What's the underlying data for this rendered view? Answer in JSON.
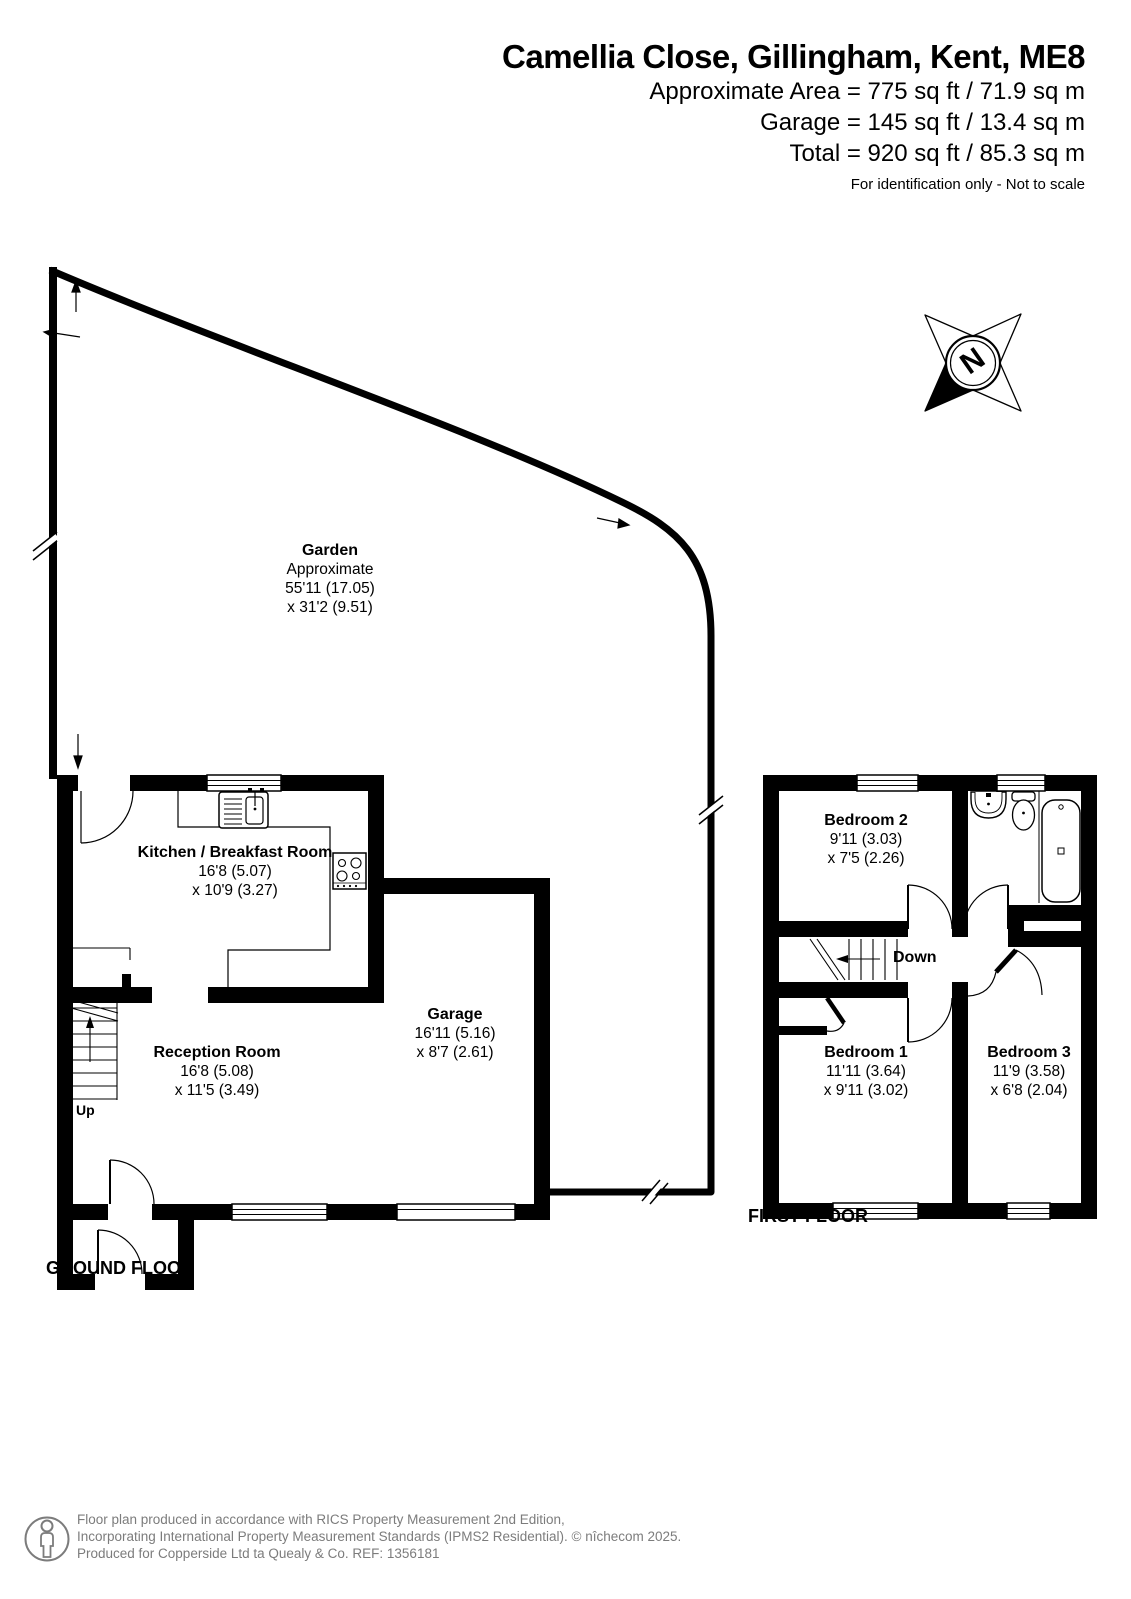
{
  "header": {
    "title": "Camellia Close, Gillingham, Kent, ME8",
    "area_line1": "Approximate Area = 775 sq ft / 71.9 sq m",
    "area_line2": "Garage = 145 sq ft / 13.4 sq m",
    "area_line3": "Total = 920 sq ft / 85.3 sq m",
    "disclaimer": "For identification only - Not to scale"
  },
  "compass": {
    "label": "N"
  },
  "rooms": {
    "garden": {
      "name": "Garden",
      "note": "Approximate",
      "dim1": "55'11 (17.05)",
      "dim2": "x 31'2 (9.51)"
    },
    "kitchen": {
      "name": "Kitchen / Breakfast Room",
      "dim1": "16'8 (5.07)",
      "dim2": "x 10'9 (3.27)"
    },
    "reception": {
      "name": "Reception Room",
      "dim1": "16'8 (5.08)",
      "dim2": "x 11'5 (3.49)"
    },
    "garage": {
      "name": "Garage",
      "dim1": "16'11 (5.16)",
      "dim2": "x 8'7 (2.61)"
    },
    "bedroom1": {
      "name": "Bedroom 1",
      "dim1": "11'11 (3.64)",
      "dim2": "x 9'11 (3.02)"
    },
    "bedroom2": {
      "name": "Bedroom 2",
      "dim1": "9'11 (3.03)",
      "dim2": "x 7'5 (2.26)"
    },
    "bedroom3": {
      "name": "Bedroom 3",
      "dim1": "11'9 (3.58)",
      "dim2": "x 6'8 (2.04)"
    }
  },
  "labels": {
    "ground_floor": "GROUND FLOOR",
    "first_floor": "FIRST FLOOR",
    "up": "Up",
    "down": "Down"
  },
  "footer": {
    "line1": "Floor plan produced in accordance with RICS Property Measurement 2nd Edition,",
    "line2": "Incorporating International Property Measurement Standards (IPMS2 Residential).   © nîchecom 2025.",
    "line3": "Produced for Copperside Ltd ta Quealy & Co.   REF: 1356181"
  },
  "colors": {
    "wall": "#000000",
    "footer_text": "#7c7c7c"
  }
}
